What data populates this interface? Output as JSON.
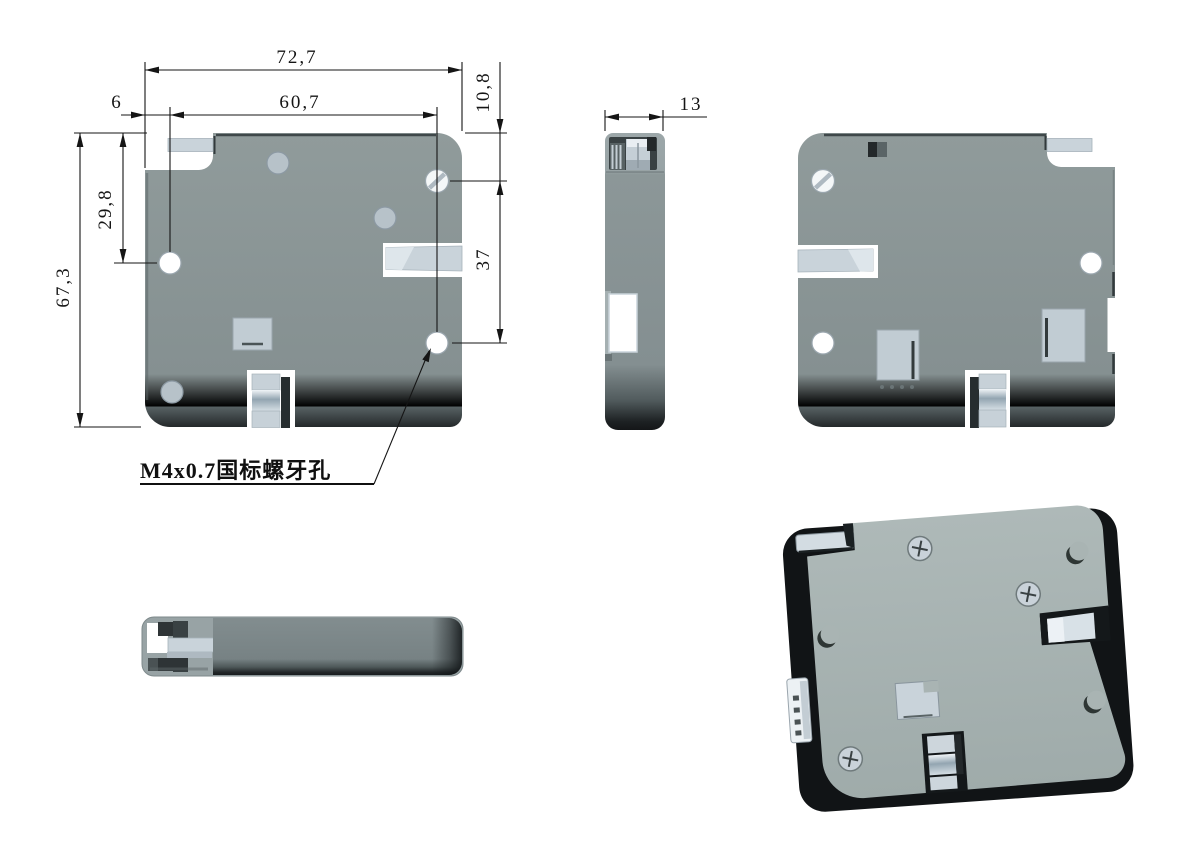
{
  "drawing": {
    "type": "engineering-drawing",
    "part": "electronic-cabinet-lock",
    "dimensions": {
      "overall_width": "72,7",
      "hole_span_horizontal": "60,7",
      "edge_to_hole": "6",
      "top_to_screw_hole": "10,8",
      "top_to_side_hole": "29,8",
      "overall_height": "67,3",
      "screw_to_lower_hole": "37",
      "body_thickness": "13"
    },
    "annotation": {
      "thread_note": "M4x0.7国标螺牙孔"
    },
    "colors": {
      "background": "#ffffff",
      "plate_gray": "#8B9697",
      "light_part": "#C9D3DA",
      "metal_highlight": "#E9EEF2",
      "dark_edge": "#1E2426",
      "iso_face": "#A9B4B3",
      "line_black": "#151515",
      "hole_white": "#FFFFFF"
    }
  }
}
